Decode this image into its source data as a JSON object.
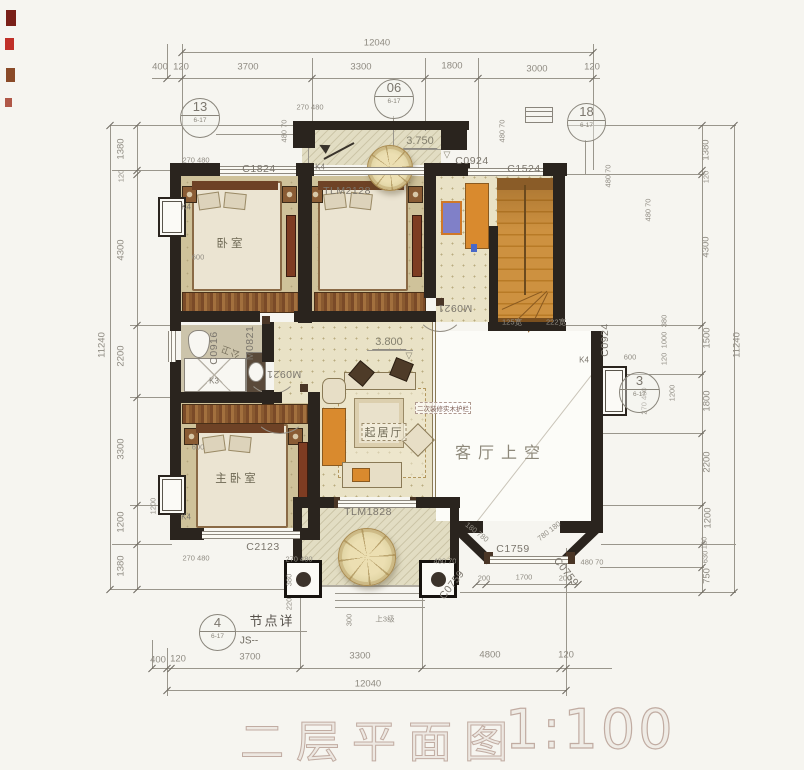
{
  "title_block": {
    "title": "二层平面图",
    "scale": "1:100"
  },
  "plan_summary": {
    "rooms": [
      "卧室",
      "公卫",
      "主卧室",
      "起居厅",
      "客厅上空"
    ],
    "levels": [
      "3.750",
      "3.800"
    ],
    "overall_dims": {
      "top": "12040",
      "bottom": "12040",
      "left": "11240",
      "right": "11240"
    }
  },
  "dims": {
    "top": [
      {
        "t": "12040",
        "x": 377,
        "y": 43,
        "n": "dim-overall-top"
      },
      {
        "t": "400",
        "x": 160,
        "y": 67
      },
      {
        "t": "120",
        "x": 181,
        "y": 67
      },
      {
        "t": "3700",
        "x": 248,
        "y": 67
      },
      {
        "t": "3300",
        "x": 361,
        "y": 67
      },
      {
        "t": "1800",
        "x": 452,
        "y": 66
      },
      {
        "t": "3000",
        "x": 537,
        "y": 69
      },
      {
        "t": "120",
        "x": 592,
        "y": 67
      }
    ],
    "bottom": [
      {
        "t": "400",
        "x": 158,
        "y": 660
      },
      {
        "t": "120",
        "x": 178,
        "y": 659
      },
      {
        "t": "3700",
        "x": 250,
        "y": 657
      },
      {
        "t": "3300",
        "x": 360,
        "y": 656
      },
      {
        "t": "4800",
        "x": 490,
        "y": 655
      },
      {
        "t": "120",
        "x": 566,
        "y": 655
      },
      {
        "t": "12040",
        "x": 368,
        "y": 684,
        "n": "dim-overall-bottom"
      }
    ],
    "left": [
      {
        "t": "11240",
        "x": 102,
        "y": 345,
        "r": -90,
        "n": "dim-overall-left"
      },
      {
        "t": "1380",
        "x": 121,
        "y": 149,
        "r": -90
      },
      {
        "t": "120",
        "x": 121,
        "y": 176,
        "r": -90,
        "c": "dim-sm"
      },
      {
        "t": "4300",
        "x": 121,
        "y": 250,
        "r": -90
      },
      {
        "t": "2200",
        "x": 121,
        "y": 356,
        "r": -90
      },
      {
        "t": "3300",
        "x": 121,
        "y": 449,
        "r": -90
      },
      {
        "t": "1200",
        "x": 121,
        "y": 522,
        "r": -90
      },
      {
        "t": "1380",
        "x": 121,
        "y": 566,
        "r": -90
      }
    ],
    "right": [
      {
        "t": "1380",
        "x": 706,
        "y": 150,
        "r": -90
      },
      {
        "t": "120",
        "x": 706,
        "y": 177,
        "r": -90,
        "c": "dim-sm"
      },
      {
        "t": "4300",
        "x": 706,
        "y": 247,
        "r": -90
      },
      {
        "t": "1500",
        "x": 707,
        "y": 338,
        "r": -90
      },
      {
        "t": "1800",
        "x": 707,
        "y": 401,
        "r": -90
      },
      {
        "t": "2200",
        "x": 707,
        "y": 462,
        "r": -90
      },
      {
        "t": "1200",
        "x": 708,
        "y": 518,
        "r": -90
      },
      {
        "t": "120",
        "x": 704,
        "y": 543,
        "r": -90,
        "c": "dim-sm"
      },
      {
        "t": "630",
        "x": 705,
        "y": 557,
        "r": -90,
        "c": "dim-sm"
      },
      {
        "t": "750",
        "x": 707,
        "y": 576,
        "r": -90
      },
      {
        "t": "11240",
        "x": 737,
        "y": 345,
        "r": -90,
        "n": "dim-overall-right"
      }
    ],
    "inner": [
      {
        "t": "270 480",
        "x": 196,
        "y": 160
      },
      {
        "t": "480 70",
        "x": 284,
        "y": 131,
        "r": -90
      },
      {
        "t": "270 480",
        "x": 310,
        "y": 107
      },
      {
        "t": "480 70",
        "x": 502,
        "y": 131,
        "r": -90
      },
      {
        "t": "480 70",
        "x": 608,
        "y": 176,
        "r": -90
      },
      {
        "t": "480 70",
        "x": 648,
        "y": 210,
        "r": -90
      },
      {
        "t": "600",
        "x": 198,
        "y": 257
      },
      {
        "t": "600",
        "x": 198,
        "y": 447
      },
      {
        "t": "1200",
        "x": 153,
        "y": 506,
        "r": -90
      },
      {
        "t": "270 480",
        "x": 196,
        "y": 558
      },
      {
        "t": "270 480",
        "x": 299,
        "y": 559
      },
      {
        "t": "480 70",
        "x": 445,
        "y": 561
      },
      {
        "t": "480 70",
        "x": 592,
        "y": 562
      },
      {
        "t": "380",
        "x": 289,
        "y": 580,
        "r": -90
      },
      {
        "t": "220",
        "x": 289,
        "y": 604,
        "r": -90
      },
      {
        "t": "300",
        "x": 349,
        "y": 620,
        "r": -90
      },
      {
        "t": "380",
        "x": 664,
        "y": 321,
        "r": -90
      },
      {
        "t": "1000",
        "x": 664,
        "y": 340,
        "r": -90
      },
      {
        "t": "120",
        "x": 664,
        "y": 359,
        "r": -90
      },
      {
        "t": "1200",
        "x": 672,
        "y": 393,
        "r": -90
      },
      {
        "t": "270 480",
        "x": 644,
        "y": 401,
        "r": -90
      },
      {
        "t": "600",
        "x": 630,
        "y": 357
      },
      {
        "t": "200",
        "x": 484,
        "y": 578
      },
      {
        "t": "1700",
        "x": 524,
        "y": 577
      },
      {
        "t": "200",
        "x": 565,
        "y": 578
      },
      {
        "t": "180 780",
        "x": 477,
        "y": 532,
        "r": 38
      },
      {
        "t": "780 180",
        "x": 549,
        "y": 531,
        "r": -38
      },
      {
        "t": "125宽",
        "x": 512,
        "y": 322
      },
      {
        "t": "222宽",
        "x": 556,
        "y": 322
      }
    ]
  },
  "codes": [
    {
      "t": "C1824",
      "x": 259,
      "y": 169
    },
    {
      "t": "TLM2128",
      "x": 347,
      "y": 191
    },
    {
      "t": "C0924",
      "x": 472,
      "y": 161
    },
    {
      "t": "C1524",
      "x": 524,
      "y": 169
    },
    {
      "t": "C0916",
      "x": 214,
      "y": 348,
      "r": -90
    },
    {
      "t": "M0821",
      "x": 250,
      "y": 343,
      "r": -90
    },
    {
      "t": "M0921",
      "x": 284,
      "y": 374,
      "r": 180
    },
    {
      "t": "M0921",
      "x": 455,
      "y": 308,
      "r": 180
    },
    {
      "t": "C2123",
      "x": 263,
      "y": 547
    },
    {
      "t": "TLM1828",
      "x": 368,
      "y": 512
    },
    {
      "t": "C1759",
      "x": 513,
      "y": 549
    },
    {
      "t": "C0759",
      "x": 452,
      "y": 585,
      "r": -52
    },
    {
      "t": "C0759",
      "x": 566,
      "y": 572,
      "r": 52
    },
    {
      "t": "C0924",
      "x": 605,
      "y": 340,
      "r": -90
    },
    {
      "t": "K4",
      "x": 186,
      "y": 207,
      "c": "code-sm"
    },
    {
      "t": "K4",
      "x": 186,
      "y": 517,
      "c": "code-sm"
    },
    {
      "t": "K4",
      "x": 320,
      "y": 167,
      "c": "code-sm"
    },
    {
      "t": "K4",
      "x": 584,
      "y": 360,
      "c": "code-sm"
    },
    {
      "t": "K3",
      "x": 214,
      "y": 381,
      "c": "code-sm"
    }
  ],
  "rooms": [
    {
      "t": "卧室",
      "x": 231,
      "y": 243,
      "c": "room"
    },
    {
      "t": "主卧室",
      "x": 237,
      "y": 478,
      "c": "room"
    },
    {
      "t": "起居厅",
      "x": 384,
      "y": 432,
      "c": "room-box"
    },
    {
      "t": "客厅上空",
      "x": 501,
      "y": 451,
      "c": "room-lg"
    },
    {
      "t": "公卫",
      "x": 230,
      "y": 352,
      "c": "room-sm",
      "r": 200
    }
  ],
  "levels": [
    {
      "t": "3.750",
      "x": 420,
      "y": 142,
      "c": "level"
    },
    {
      "t": "▽",
      "x": 447,
      "y": 155,
      "c": "level-tri"
    },
    {
      "t": "3.800",
      "x": 389,
      "y": 343,
      "c": "level"
    },
    {
      "t": "▽",
      "x": 409,
      "y": 356,
      "c": "level-tri"
    }
  ],
  "notes": [
    {
      "t": "节点详",
      "x": 272,
      "y": 620,
      "c": "note-lg"
    },
    {
      "t": "JS--",
      "x": 249,
      "y": 641,
      "c": "note"
    },
    {
      "t": "上3级",
      "x": 385,
      "y": 619,
      "c": "dim-sm"
    },
    {
      "t": "二次装修实木护栏",
      "x": 443,
      "y": 408,
      "c": "note-sm"
    }
  ],
  "bubbles": [
    {
      "no": "13",
      "sheet": "6-17",
      "x": 180,
      "y": 98,
      "d": 38
    },
    {
      "no": "06",
      "sheet": "6-17",
      "x": 374,
      "y": 79,
      "d": 38
    },
    {
      "no": "18",
      "sheet": "6-17",
      "x": 567,
      "y": 103,
      "d": 37
    },
    {
      "no": "3",
      "sheet": "6-17",
      "x": 619,
      "y": 372,
      "d": 39
    },
    {
      "no": "4",
      "sheet": "6-17",
      "x": 199,
      "y": 614,
      "d": 35
    }
  ]
}
